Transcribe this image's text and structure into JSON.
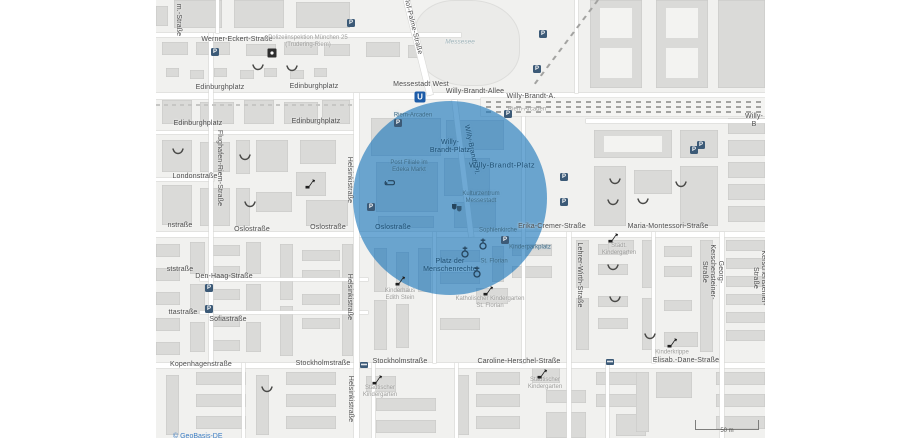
{
  "map": {
    "attribution": "© GeoBasis-DE",
    "scale_bar": "50 m",
    "highlight": {
      "center_label": "Willy-Brandt-Platz",
      "color": "rgba(23,116,186,0.62)"
    },
    "street_labels": [
      {
        "t": "Werner-Eckert-Straße",
        "x": 81,
        "y": 40,
        "r": 0,
        "c": "s"
      },
      {
        "t": "Edinburghplatz",
        "x": 64,
        "y": 88,
        "r": 0,
        "c": "s"
      },
      {
        "t": "Edinburghplatz",
        "x": 158,
        "y": 87,
        "r": 0,
        "c": "s"
      },
      {
        "t": "Edinburghplatz",
        "x": 42,
        "y": 124,
        "r": 0,
        "c": "s"
      },
      {
        "t": "Edinburghplatz",
        "x": 160,
        "y": 122,
        "r": 0,
        "c": "s"
      },
      {
        "t": "Messestadt West",
        "x": 265,
        "y": 85,
        "r": 0,
        "c": "s"
      },
      {
        "t": "Willy-Brandt-Allee",
        "x": 319,
        "y": 92,
        "r": 0,
        "c": "s"
      },
      {
        "t": "Willy-Brandt-A.",
        "x": 375,
        "y": 97,
        "r": 0,
        "c": "s"
      },
      {
        "t": "Willy-B",
        "x": 598,
        "y": 121,
        "r": 0,
        "c": "s"
      },
      {
        "t": "Londonstraße",
        "x": 39,
        "y": 177,
        "r": 0,
        "c": "s"
      },
      {
        "t": "nstraße",
        "x": 24,
        "y": 226,
        "r": 0,
        "c": "s"
      },
      {
        "t": "Oslostraße",
        "x": 96,
        "y": 230,
        "r": 0,
        "c": "s"
      },
      {
        "t": "Oslostraße",
        "x": 172,
        "y": 228,
        "r": 0,
        "c": "s"
      },
      {
        "t": "Oslostraße",
        "x": 237,
        "y": 228,
        "r": 0,
        "c": "n"
      },
      {
        "t": "Erika-Cremer-Straße",
        "x": 396,
        "y": 227,
        "r": 0,
        "c": "s"
      },
      {
        "t": "Maria-Montessori-Straße",
        "x": 512,
        "y": 227,
        "r": 0,
        "c": "s"
      },
      {
        "t": "ststraße",
        "x": 24,
        "y": 270,
        "r": 0,
        "c": "s"
      },
      {
        "t": "Den-Haag-Straße",
        "x": 68,
        "y": 277,
        "r": 0,
        "c": "s"
      },
      {
        "t": "ttastraße",
        "x": 27,
        "y": 313,
        "r": 0,
        "c": "s"
      },
      {
        "t": "Sofiastraße",
        "x": 72,
        "y": 320,
        "r": 0,
        "c": "s"
      },
      {
        "t": "Kopenhagenstraße",
        "x": 45,
        "y": 365,
        "r": 0,
        "c": "s"
      },
      {
        "t": "Stockholmstraße",
        "x": 167,
        "y": 364,
        "r": 0,
        "c": "s"
      },
      {
        "t": "Stockholmstraße",
        "x": 244,
        "y": 362,
        "r": 0,
        "c": "s"
      },
      {
        "t": "Caroline-Herschel-Straße",
        "x": 363,
        "y": 362,
        "r": 0,
        "c": "s"
      },
      {
        "t": "Elisab.-Dane-Straße",
        "x": 530,
        "y": 361,
        "r": 0,
        "c": "s"
      },
      {
        "t": "m.-Straße",
        "x": 22,
        "y": 20,
        "r": 90,
        "c": "s"
      },
      {
        "t": "Flughafen-Riem-Straße",
        "x": 63,
        "y": 168,
        "r": 90,
        "c": "s"
      },
      {
        "t": "Helsinkistraße",
        "x": 193,
        "y": 180,
        "r": 90,
        "c": "s"
      },
      {
        "t": "Helsinkistraße",
        "x": 193,
        "y": 297,
        "r": 90,
        "c": "s"
      },
      {
        "t": "Helsinkistraße",
        "x": 194,
        "y": 399,
        "r": 90,
        "c": "s"
      },
      {
        "t": "Lehrer-Wirth-Straße",
        "x": 423,
        "y": 275,
        "r": 90,
        "c": "s"
      },
      {
        "t": "Georg-Kerschensteiner-Straße",
        "x": 556,
        "y": 272,
        "r": 90,
        "c": "s"
      },
      {
        "t": "Georg-Kerschensteiner-Straße",
        "x": 607,
        "y": 278,
        "r": 90,
        "c": "s"
      },
      {
        "t": "Willy-Brandt-Pl.",
        "x": 315,
        "y": 150,
        "r": 78,
        "c": "n"
      },
      {
        "t": "Olof-Palme-Straße",
        "x": 256,
        "y": 25,
        "r": 76,
        "c": "s"
      },
      {
        "t": "Willy-Brandt-Platz",
        "x": 346,
        "y": 166,
        "r": 0,
        "c": "n8"
      },
      {
        "t": "Willy-\nBrandt-Platz",
        "x": 294,
        "y": 147,
        "r": 0,
        "c": "n"
      },
      {
        "t": "Platz der\nMenschenrechte",
        "x": 294,
        "y": 266,
        "r": 0,
        "c": "n"
      }
    ],
    "place_labels": [
      {
        "t": "Polizeiinspektion München 25\n(Trudering-Riem)",
        "x": 152,
        "y": 42,
        "c": "g"
      },
      {
        "t": "Messesee",
        "x": 304,
        "y": 42,
        "c": "w"
      },
      {
        "t": "Riem-Arcaden",
        "x": 257,
        "y": 116,
        "c": "a"
      },
      {
        "t": "Riem-Arcaden",
        "x": 371,
        "y": 110,
        "c": "g"
      },
      {
        "t": "Post Filiale im\nEdeka Markt",
        "x": 253,
        "y": 167,
        "c": "a"
      },
      {
        "t": "Kulturzentrum\nMessestadt",
        "x": 325,
        "y": 198,
        "c": "a"
      },
      {
        "t": "Sophienkirche",
        "x": 342,
        "y": 231,
        "c": "a"
      },
      {
        "t": "Kinderparkplatz",
        "x": 374,
        "y": 248,
        "c": "a"
      },
      {
        "t": "St. Florian",
        "x": 338,
        "y": 262,
        "c": "a"
      },
      {
        "t": "Kinderhaus\nEdith Stein",
        "x": 244,
        "y": 295,
        "c": "g"
      },
      {
        "t": "Katholischer Kindergarten\nSt. Florian",
        "x": 334,
        "y": 303,
        "c": "g"
      },
      {
        "t": "Städt.\nKindergarten",
        "x": 463,
        "y": 250,
        "c": "g"
      },
      {
        "t": "Städtischer\nKindergarten",
        "x": 224,
        "y": 392,
        "c": "g"
      },
      {
        "t": "Städtischer\nKindergarten",
        "x": 389,
        "y": 384,
        "c": "g"
      },
      {
        "t": "Kinderkrippe",
        "x": 516,
        "y": 353,
        "c": "g"
      }
    ],
    "icons": [
      {
        "k": "ubahn",
        "x": 264,
        "y": 97
      },
      {
        "k": "police",
        "x": 116,
        "y": 53
      },
      {
        "k": "posthorn",
        "x": 234,
        "y": 183
      },
      {
        "k": "theatre",
        "x": 301,
        "y": 208
      },
      {
        "k": "church",
        "x": 327,
        "y": 244
      },
      {
        "k": "church",
        "x": 309,
        "y": 252
      },
      {
        "k": "church",
        "x": 321,
        "y": 272
      },
      {
        "k": "bus",
        "x": 208,
        "y": 365
      },
      {
        "k": "bus",
        "x": 454,
        "y": 362
      },
      {
        "k": "parking",
        "x": 195,
        "y": 23
      },
      {
        "k": "parking",
        "x": 59,
        "y": 52
      },
      {
        "k": "parking",
        "x": 387,
        "y": 34
      },
      {
        "k": "parking",
        "x": 381,
        "y": 69
      },
      {
        "k": "parking",
        "x": 538,
        "y": 150
      },
      {
        "k": "parking",
        "x": 545,
        "y": 145
      },
      {
        "k": "parking",
        "x": 408,
        "y": 177
      },
      {
        "k": "parking",
        "x": 408,
        "y": 202
      },
      {
        "k": "parking",
        "x": 349,
        "y": 240
      },
      {
        "k": "parking",
        "x": 53,
        "y": 288
      },
      {
        "k": "parking",
        "x": 53,
        "y": 309
      },
      {
        "k": "parking",
        "x": 242,
        "y": 123
      },
      {
        "k": "parking",
        "x": 352,
        "y": 114
      },
      {
        "k": "parking",
        "x": 215,
        "y": 207
      },
      {
        "k": "playground",
        "x": 102,
        "y": 68
      },
      {
        "k": "playground",
        "x": 136,
        "y": 69
      },
      {
        "k": "playground",
        "x": 22,
        "y": 152
      },
      {
        "k": "playground",
        "x": 89,
        "y": 158
      },
      {
        "k": "playground",
        "x": 94,
        "y": 205
      },
      {
        "k": "playground",
        "x": 111,
        "y": 390
      },
      {
        "k": "playground",
        "x": 459,
        "y": 182
      },
      {
        "k": "playground",
        "x": 525,
        "y": 185
      },
      {
        "k": "playground",
        "x": 457,
        "y": 203
      },
      {
        "k": "playground",
        "x": 487,
        "y": 202
      },
      {
        "k": "playground",
        "x": 457,
        "y": 268
      },
      {
        "k": "playground",
        "x": 459,
        "y": 300
      },
      {
        "k": "playground",
        "x": 494,
        "y": 337
      },
      {
        "k": "slide",
        "x": 154,
        "y": 184
      },
      {
        "k": "slide",
        "x": 244,
        "y": 281
      },
      {
        "k": "slide",
        "x": 332,
        "y": 291
      },
      {
        "k": "slide",
        "x": 221,
        "y": 380
      },
      {
        "k": "slide",
        "x": 457,
        "y": 238
      },
      {
        "k": "slide",
        "x": 516,
        "y": 343
      },
      {
        "k": "slide",
        "x": 386,
        "y": 374
      }
    ]
  }
}
